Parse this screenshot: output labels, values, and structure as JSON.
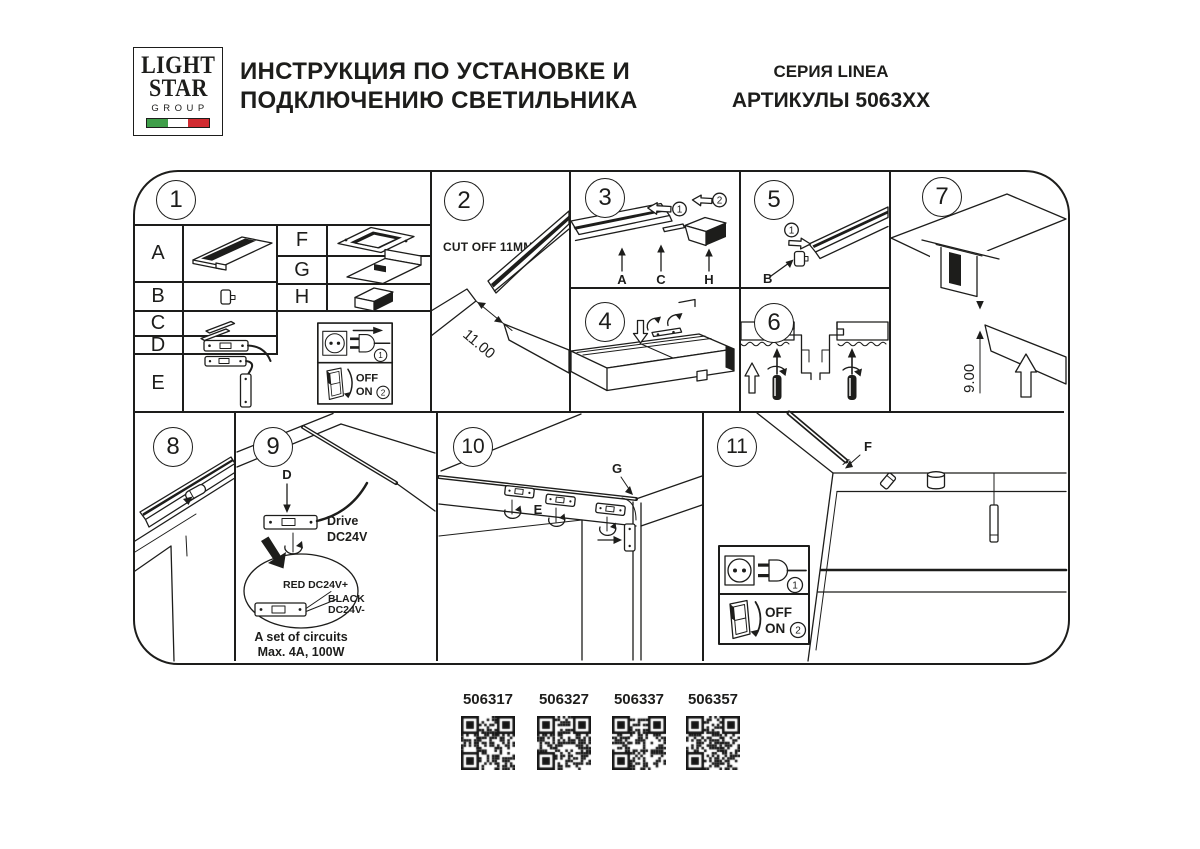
{
  "header": {
    "logo_line1": "LIGHT",
    "logo_line2": "STAR",
    "logo_line3": "GROUP",
    "title_line1": "ИНСТРУКЦИЯ ПО УСТАНОВКЕ И",
    "title_line2": "ПОДКЛЮЧЕНИЮ СВЕТИЛЬНИКА",
    "series": "СЕРИЯ LINEA",
    "articles": "АРТИКУЛЫ 5063XX"
  },
  "colors": {
    "line": "#1d1d1b",
    "flag_green": "#3f9e49",
    "flag_white": "#ffffff",
    "flag_red": "#d12b31"
  },
  "steps": {
    "s1": "1",
    "s2": "2",
    "s3": "3",
    "s4": "4",
    "s5": "5",
    "s6": "6",
    "s7": "7",
    "s8": "8",
    "s9": "9",
    "s10": "10",
    "s11": "11"
  },
  "parts": {
    "a": "A",
    "b": "B",
    "c": "C",
    "d": "D",
    "e": "E",
    "f": "F",
    "g": "G",
    "h": "H"
  },
  "markers": {
    "m1": "1",
    "m2": "2"
  },
  "panel2": {
    "cut_note": "CUT OFF 11MM",
    "dim": "11.00"
  },
  "panel7": {
    "dim": "9.00"
  },
  "panel9": {
    "drive_line1": "Drive",
    "drive_line2": "DC24V",
    "wire_red": "RED DC24V+",
    "wire_black_line1": "BLACK",
    "wire_black_line2": "DC24V-",
    "circuits_line1": "A set of circuits",
    "circuits_line2": "Max. 4A, 100W"
  },
  "power_box": {
    "step_plug": "1",
    "step_switch": "2",
    "off": "OFF",
    "on": "ON"
  },
  "qr": [
    {
      "code": "506317"
    },
    {
      "code": "506327"
    },
    {
      "code": "506337"
    },
    {
      "code": "506357"
    }
  ]
}
